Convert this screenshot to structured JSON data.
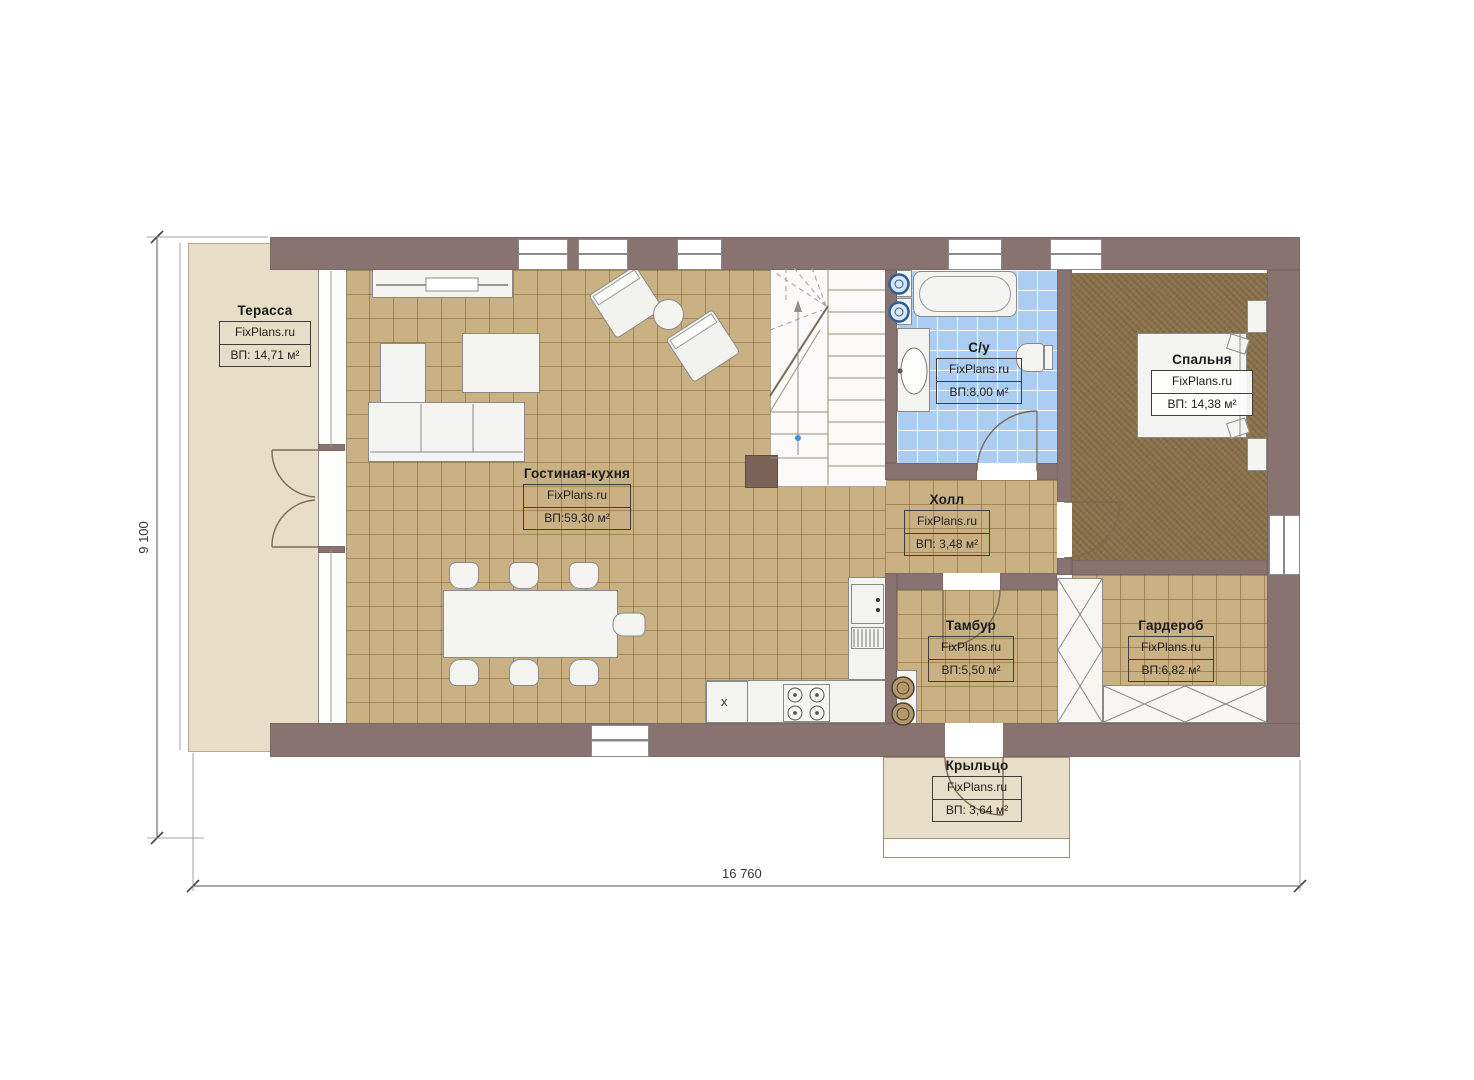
{
  "plan": {
    "brand_watermark": "FixPlans.ru",
    "dimension_labels": {
      "horizontal": "16 760",
      "vertical": "9 100"
    },
    "rooms": {
      "terrace": {
        "name": "Терасса",
        "watermark": "FixPlans.ru",
        "area": "ВП: 14,71 м²"
      },
      "living_kitchen": {
        "name": "Гостиная-кухня",
        "watermark": "FixPlans.ru",
        "area": "ВП:59,30 м²"
      },
      "bathroom": {
        "name": "С/у",
        "watermark": "FixPlans.ru",
        "area": "ВП:8,00 м²"
      },
      "bedroom": {
        "name": "Спальня",
        "watermark": "FixPlans.ru",
        "area": "ВП: 14,38 м²"
      },
      "hall": {
        "name": "Холл",
        "watermark": "FixPlans.ru",
        "area": "ВП: 3,48 м²"
      },
      "vestibule": {
        "name": "Тамбур",
        "watermark": "FixPlans.ru",
        "area": "ВП:5,50 м²"
      },
      "wardrobe": {
        "name": "Гардероб",
        "watermark": "FixPlans.ru",
        "area": "ВП:6,82 м²"
      },
      "porch": {
        "name": "Крыльцо",
        "watermark": "FixPlans.ru",
        "area": "ВП: 3,64 м²"
      }
    },
    "fixtures": {
      "appliance_mark": "x"
    },
    "colors": {
      "wall": "#887371",
      "tile_floor": "#c9b184",
      "wet_floor": "#abcdf1",
      "carpet_floor": "#8b734d",
      "deck": "#e8dec8",
      "appliance_blue": "#6f9fd8"
    }
  }
}
